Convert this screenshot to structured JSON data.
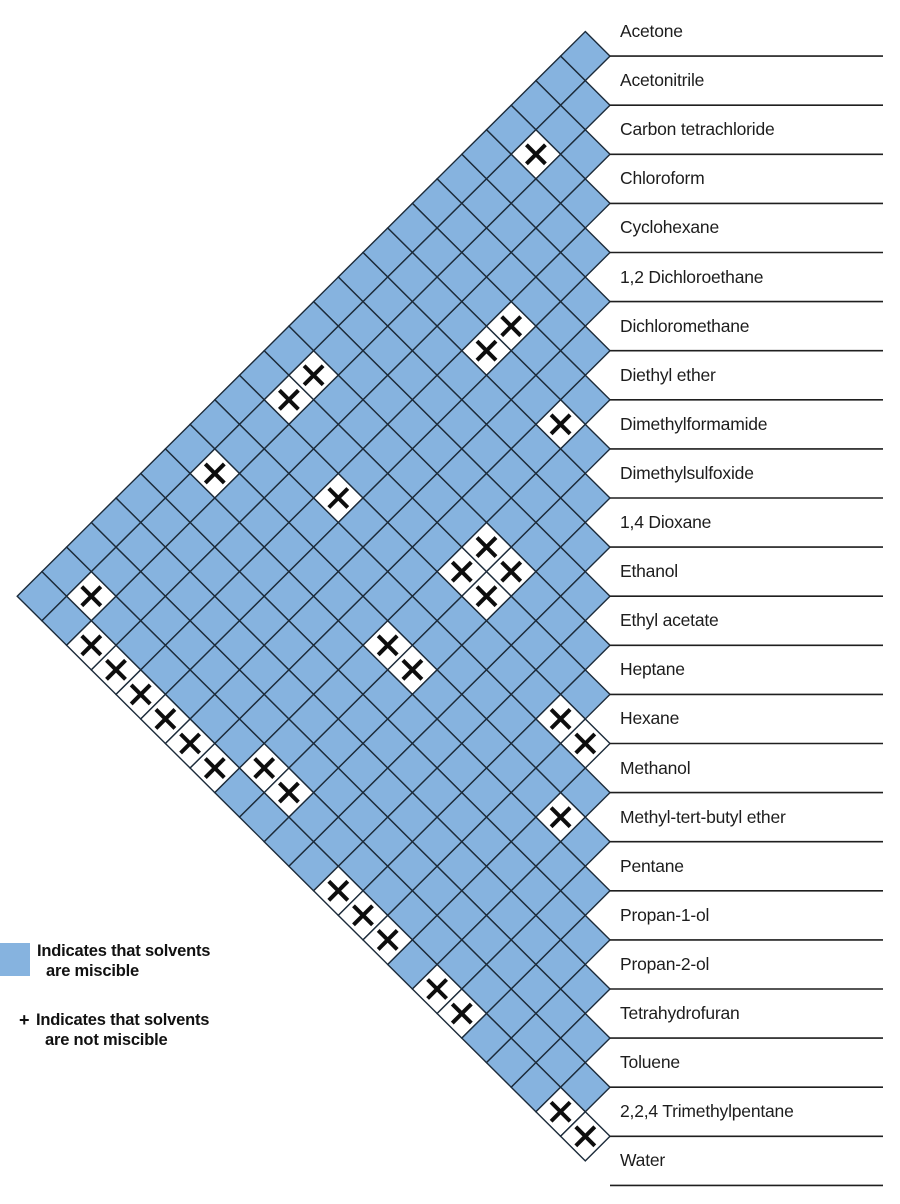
{
  "chart_data": {
    "type": "heatmap",
    "subtype": "triangular-solvent-miscibility-matrix",
    "solvents": [
      "Acetone",
      "Acetonitrile",
      "Carbon tetrachloride",
      "Chloroform",
      "Cyclohexane",
      "1,2 Dichloroethane",
      "Dichloromethane",
      "Diethyl ether",
      "Dimethylformamide",
      "Dimethylsulfoxide",
      "1,4 Dioxane",
      "Ethanol",
      "Ethyl acetate",
      "Heptane",
      "Hexane",
      "Methanol",
      "Methyl-tert-butyl ether",
      "Pentane",
      "Propan-1-ol",
      "Propan-2-ol",
      "Tetrahydrofuran",
      "Toluene",
      "2,2,4 Trimethylpentane",
      "Water"
    ],
    "immiscible_pairs": [
      [
        1,
        4
      ],
      [
        1,
        13
      ],
      [
        1,
        14
      ],
      [
        1,
        17
      ],
      [
        1,
        22
      ],
      [
        2,
        23
      ],
      [
        3,
        23
      ],
      [
        4,
        8
      ],
      [
        4,
        9
      ],
      [
        4,
        15
      ],
      [
        4,
        23
      ],
      [
        5,
        23
      ],
      [
        6,
        23
      ],
      [
        7,
        9
      ],
      [
        7,
        23
      ],
      [
        8,
        13
      ],
      [
        8,
        14
      ],
      [
        8,
        17
      ],
      [
        8,
        22
      ],
      [
        9,
        13
      ],
      [
        9,
        14
      ],
      [
        9,
        17
      ],
      [
        9,
        22
      ],
      [
        12,
        23
      ],
      [
        13,
        15
      ],
      [
        13,
        23
      ],
      [
        14,
        15
      ],
      [
        14,
        23
      ],
      [
        15,
        17
      ],
      [
        16,
        23
      ],
      [
        17,
        23
      ],
      [
        21,
        23
      ],
      [
        22,
        23
      ]
    ],
    "immiscible_pair_names": [
      "Acetonitrile / Cyclohexane",
      "Acetonitrile / Heptane",
      "Acetonitrile / Hexane",
      "Acetonitrile / Pentane",
      "Acetonitrile / 2,2,4 Trimethylpentane",
      "Carbon tetrachloride / Water",
      "Chloroform / Water",
      "Cyclohexane / Dimethylformamide",
      "Cyclohexane / Dimethylsulfoxide",
      "Cyclohexane / Methanol",
      "Cyclohexane / Water",
      "1,2 Dichloroethane / Water",
      "Dichloromethane / Water",
      "Diethyl ether / Dimethylsulfoxide",
      "Diethyl ether / Water",
      "Dimethylformamide / Heptane",
      "Dimethylformamide / Hexane",
      "Dimethylformamide / Pentane",
      "Dimethylformamide / 2,2,4 Trimethylpentane",
      "Dimethylsulfoxide / Heptane",
      "Dimethylsulfoxide / Hexane",
      "Dimethylsulfoxide / Pentane",
      "Dimethylsulfoxide / 2,2,4 Trimethylpentane",
      "Ethyl acetate / Water",
      "Heptane / Methanol",
      "Heptane / Water",
      "Hexane / Methanol",
      "Hexane / Water",
      "Methanol / Pentane",
      "Methyl-tert-butyl ether / Water",
      "Pentane / Water",
      "Toluene / Water",
      "2,2,4 Trimethylpentane / Water"
    ],
    "miscible_color": "#86B3DF",
    "immiscible_cell_color": "#FFFFFF",
    "grid_line_color": "#1C2B3A",
    "divider_line_color": "#1F1F1F",
    "mark_symbol": "+",
    "mark_color": "#0D0D0D"
  },
  "legend": {
    "miscible_symbol": "blue-square",
    "miscible_line1": "Indicates that solvents",
    "miscible_line2": "are miscible",
    "immiscible_symbol": "+",
    "immiscible_line1": "Indicates that solvents",
    "immiscible_line2": "are not miscible"
  }
}
